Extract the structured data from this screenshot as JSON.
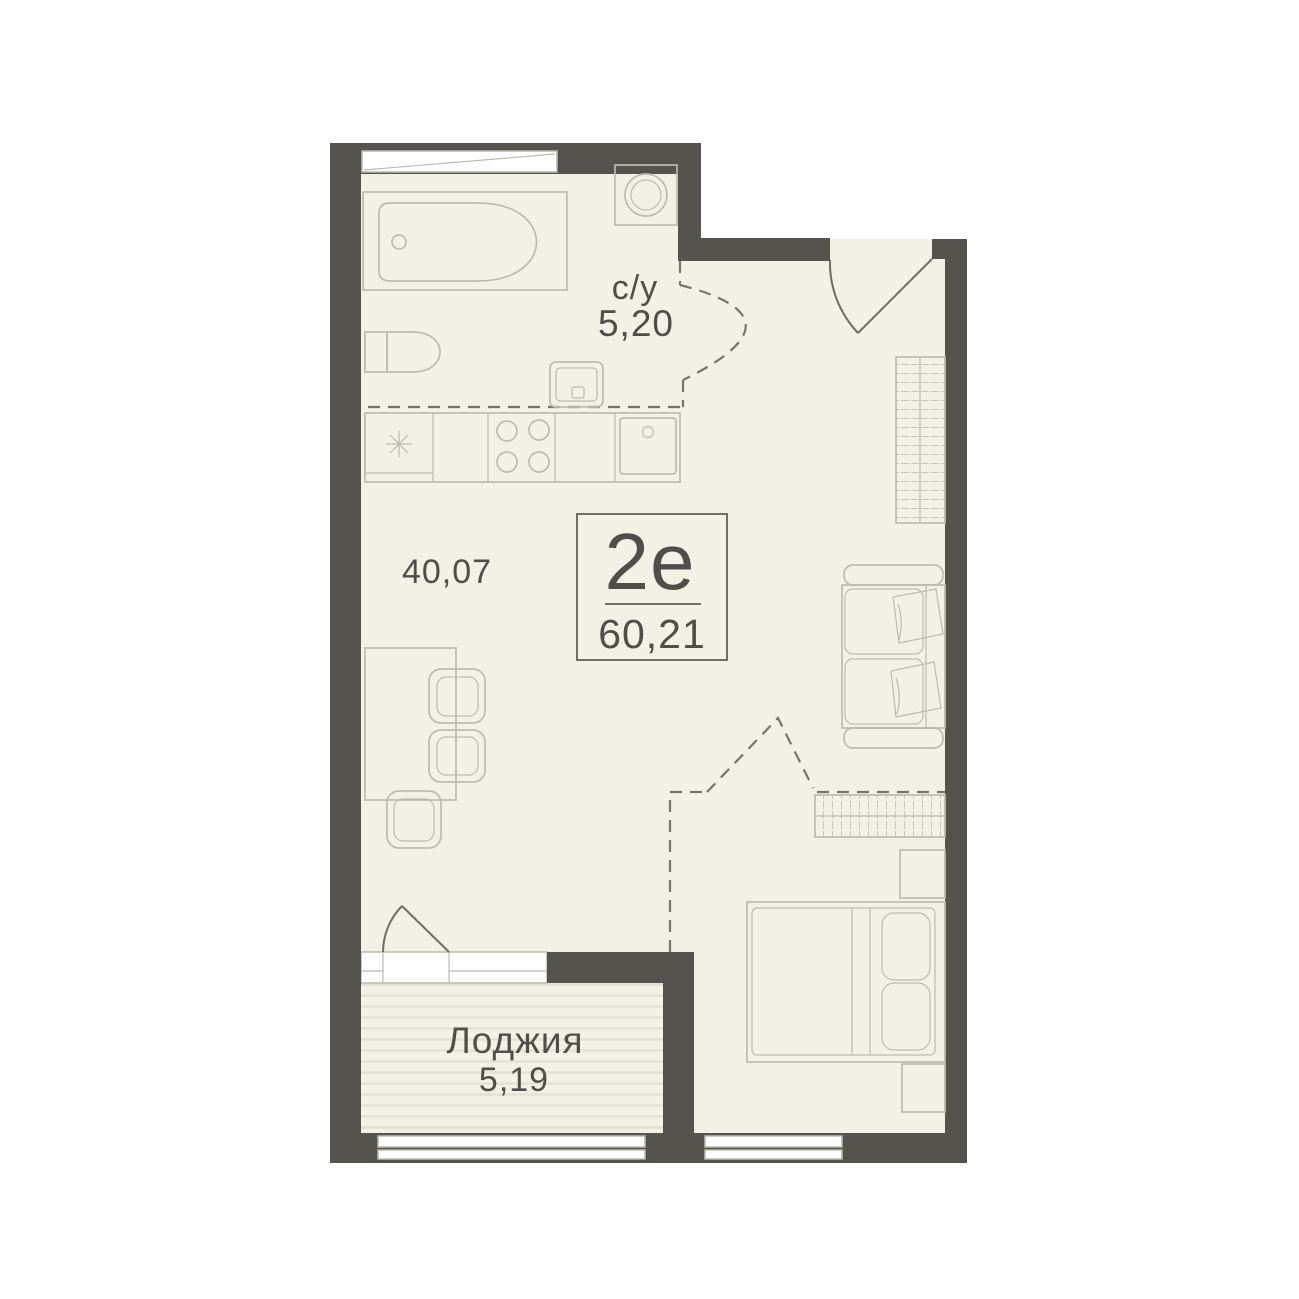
{
  "unit": {
    "type_label": "2е",
    "total_area": "60,21"
  },
  "labels": {
    "bathroom_name": "с/у",
    "bathroom_area": "5,20",
    "living_area": "40,07",
    "loggia_name": "Лоджия",
    "loggia_area": "5,19"
  },
  "colors": {
    "background": "#FFFFFF",
    "wall": "#54534D",
    "floor": "#F2F1E5",
    "loggia_stripe": "#E3E2D4",
    "furniture_stroke": "#BCBBAE",
    "hatch_stroke": "#C9C8BB",
    "door_stroke": "#6E6D66",
    "dashed_stroke": "#76756D",
    "window_fill": "#FFFFFF",
    "box_border": "#6F6E67",
    "text": "#4F4E49"
  }
}
